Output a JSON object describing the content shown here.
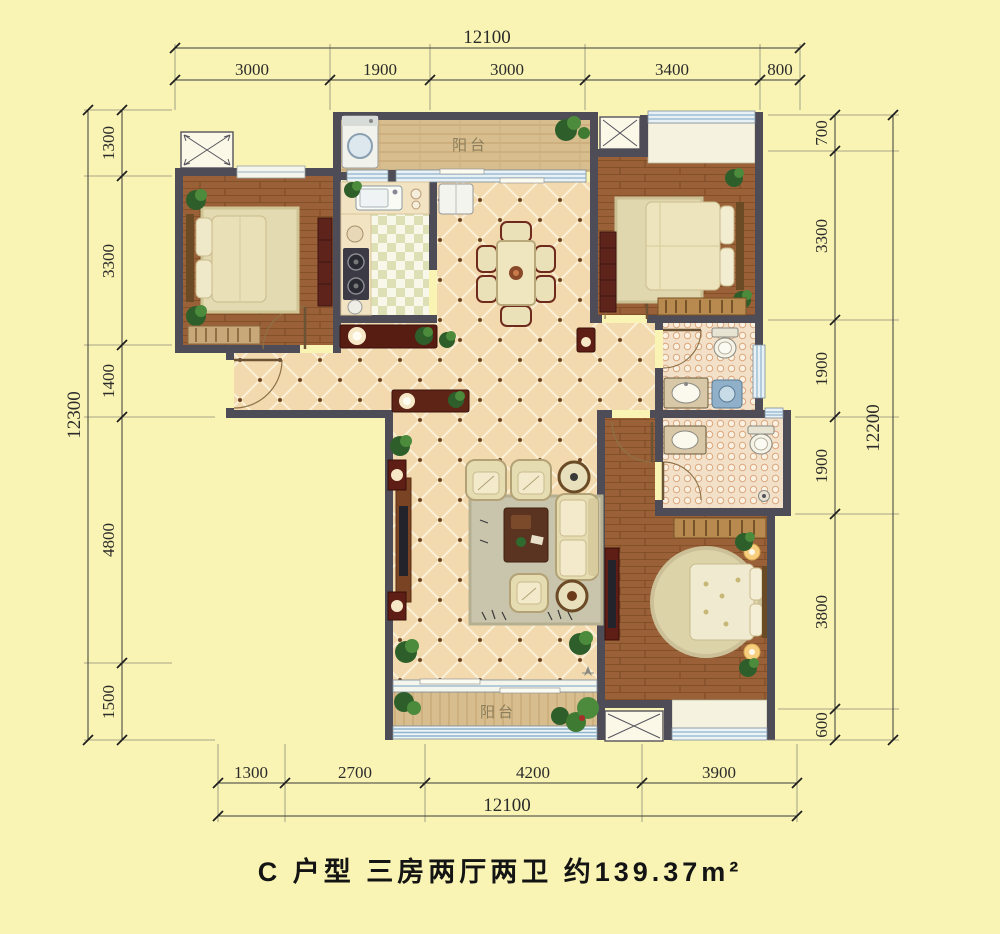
{
  "title": "C 户型 三房两厅两卫 约139.37m²",
  "plan": {
    "room_labels": {
      "balcony_top": "阳台",
      "balcony_bottom": "阳台"
    }
  },
  "dimensions": {
    "top": {
      "total": "12100",
      "segments": [
        "3000",
        "1900",
        "3000",
        "3400",
        "800"
      ]
    },
    "left": {
      "total": "12300",
      "segments": [
        "1300",
        "3300",
        "1400",
        "4800",
        "1500"
      ]
    },
    "right": {
      "total": "12200",
      "segments": [
        "700",
        "3300",
        "1900",
        "1900",
        "3800",
        "600"
      ]
    },
    "bottom": {
      "total": "12100",
      "segments": [
        "1300",
        "2700",
        "4200",
        "3900"
      ]
    }
  },
  "colors": {
    "background": "#FAF4B4",
    "wall": "#4E4C56",
    "dimension_line": "#3A3A3A",
    "tile_floor": "#F2DAAE",
    "wood_floor": "#9A6138",
    "balcony_floor": "#D8BD8E",
    "kitchen_tile": "#DCE0B4",
    "bath_tile": "#F2E0C8",
    "furniture_dark_red": "#5E1D15",
    "window_blue": "#8FB4CC"
  }
}
